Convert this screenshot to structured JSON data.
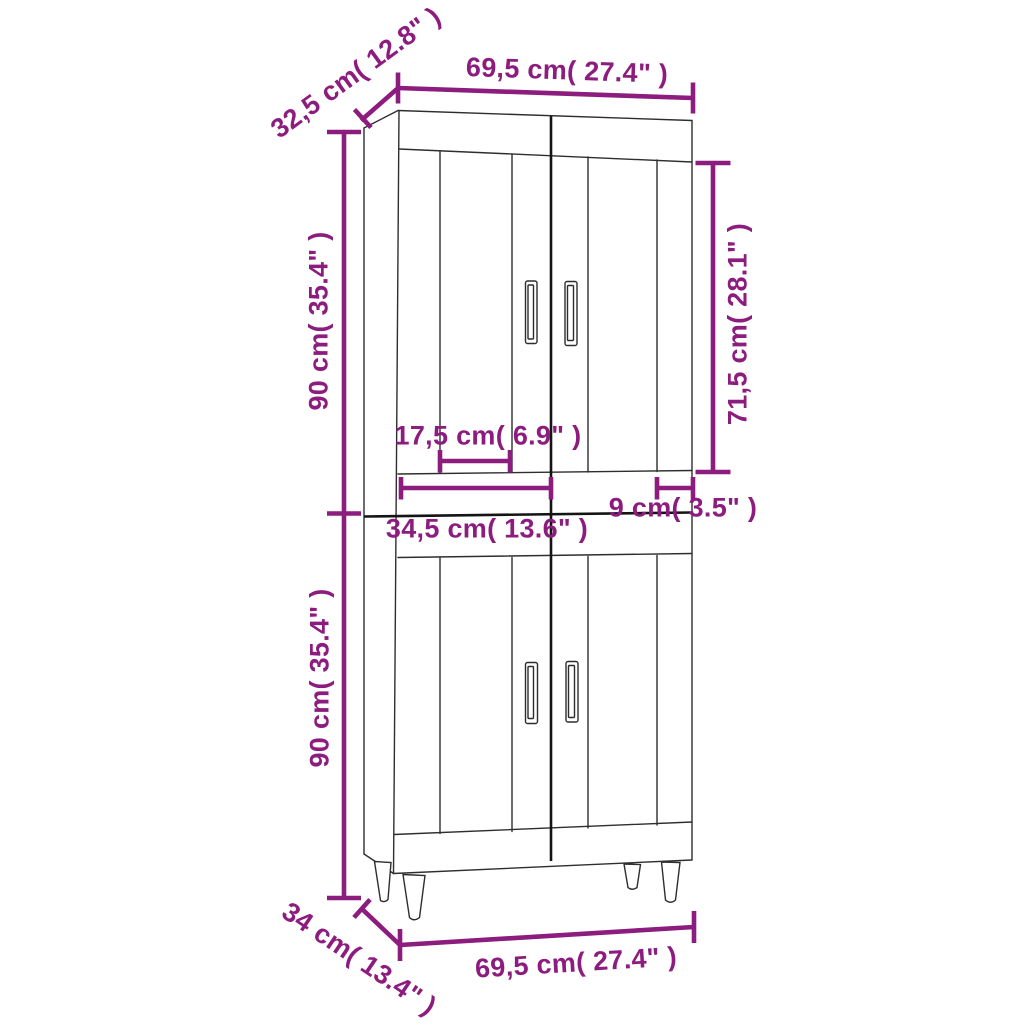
{
  "diagram": {
    "kind": "product-dimension-diagram",
    "subject": "two-section highboard cabinet with four doors and legs",
    "accent_color": "#8C1C7E",
    "line_color": "#2E2E2E",
    "line_dark_color": "#141414",
    "background_color": "#FFFFFF"
  },
  "measurements": {
    "width_top": "69,5 cm( 27.4\" )",
    "depth_top": "32,5 cm( 12.8\" )",
    "upper_height": "90 cm( 35.4\" )",
    "door_height": "71,5 cm( 28.1\" )",
    "panel_width": "17,5 cm( 6.9\" )",
    "door_width": "34,5 cm( 13.6\" )",
    "stile_width": "9 cm( 3.5\" )",
    "lower_height": "90 cm( 35.4\" )",
    "depth_bottom": "34 cm( 13.4\" )",
    "width_bottom": "69,5 cm( 27.4\" )"
  }
}
